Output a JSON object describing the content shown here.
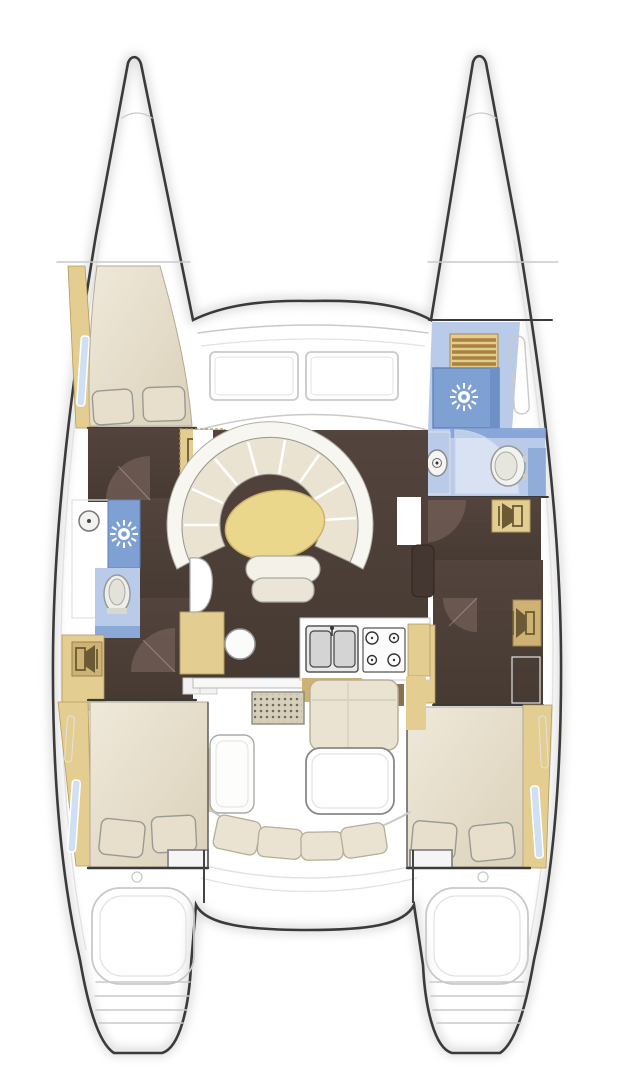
{
  "diagram": {
    "kind": "boat-floor-plan",
    "subject": "catamaran-yacht-deck-layout",
    "orientation": "bow-up",
    "hull_count": 2,
    "visible_text": ""
  },
  "rooms": [
    {
      "id": "port-forward-cabin",
      "fixtures": [
        "double-berth",
        "pillows",
        "side-shelf",
        "hull-window"
      ]
    },
    {
      "id": "port-head",
      "fixtures": [
        "washbasin",
        "shower",
        "toilet"
      ]
    },
    {
      "id": "port-aft-cabin",
      "fixtures": [
        "double-berth",
        "pillows",
        "side-shelf",
        "hull-window"
      ]
    },
    {
      "id": "starboard-forward-head",
      "fixtures": [
        "vent-hatch",
        "shower",
        "washbasin",
        "toilet",
        "hull-window"
      ]
    },
    {
      "id": "starboard-cabin-corridor",
      "fixtures": [
        "lockers",
        "shelf"
      ]
    },
    {
      "id": "starboard-aft-cabin",
      "fixtures": [
        "double-berth",
        "pillows",
        "side-shelf",
        "hull-window"
      ]
    },
    {
      "id": "salon",
      "fixtures": [
        "curved-settee",
        "oval-table",
        "seat",
        "nav-desk",
        "stool"
      ]
    },
    {
      "id": "galley",
      "fixtures": [
        "double-sink",
        "stove-4-burner",
        "counters",
        "cabinets"
      ]
    },
    {
      "id": "cockpit",
      "fixtures": [
        "deck-grating",
        "bench-l",
        "table",
        "curved-bench",
        "helm-seat"
      ]
    },
    {
      "id": "foredeck",
      "fixtures": [
        "coachroof-windows"
      ]
    },
    {
      "id": "sterns",
      "fixtures": [
        "swim-platform-steps",
        "swim-platform-steps"
      ]
    }
  ],
  "counts": {
    "double_berths": 3,
    "heads": 2,
    "shower_icons": 2,
    "toilets": 2,
    "washbasins": 2,
    "locker_speaker_icons": 4
  },
  "icons": [
    {
      "name": "shower-rose-icon",
      "glyph": "sunburst"
    },
    {
      "name": "toilet-icon",
      "glyph": "oval-bowl"
    },
    {
      "name": "washbasin-icon",
      "glyph": "circle-drain"
    },
    {
      "name": "stove-icon",
      "glyph": "four-burners"
    },
    {
      "name": "double-sink-icon",
      "glyph": "two-basins"
    },
    {
      "name": "locker-speaker-icon",
      "glyph": "speaker-cone"
    },
    {
      "name": "deck-grating-icon",
      "glyph": "dot-grid"
    },
    {
      "name": "vent-hatch-icon",
      "glyph": "slats"
    }
  ],
  "palette": {
    "outline": "#3a3a3a",
    "white": "#ffffff",
    "faint": "#c9c9c9",
    "fainter": "#e2e2e2",
    "tan": "#e3cd90",
    "tandark": "#cdb274",
    "tanline": "#b49a5c",
    "slat": "#a9823f",
    "cream": "#eae3d1",
    "pillow": "#e7dfcb",
    "bedline": "#b3aa96",
    "brown": "#4c3e38",
    "brownlight": "#6e5c54",
    "brownaccent": "#8a6f52",
    "blue": "#7fa0d3",
    "bluedark": "#6d90c6",
    "bluelight": "#b9cbe9",
    "windowblue": "#cfe0f2",
    "tableyellow": "#ebd78b",
    "steel": "#d6d6d6",
    "grate": "#d6cfba",
    "gratedot": "#6f6a5c",
    "benchwhite": "#f7f6f1"
  }
}
